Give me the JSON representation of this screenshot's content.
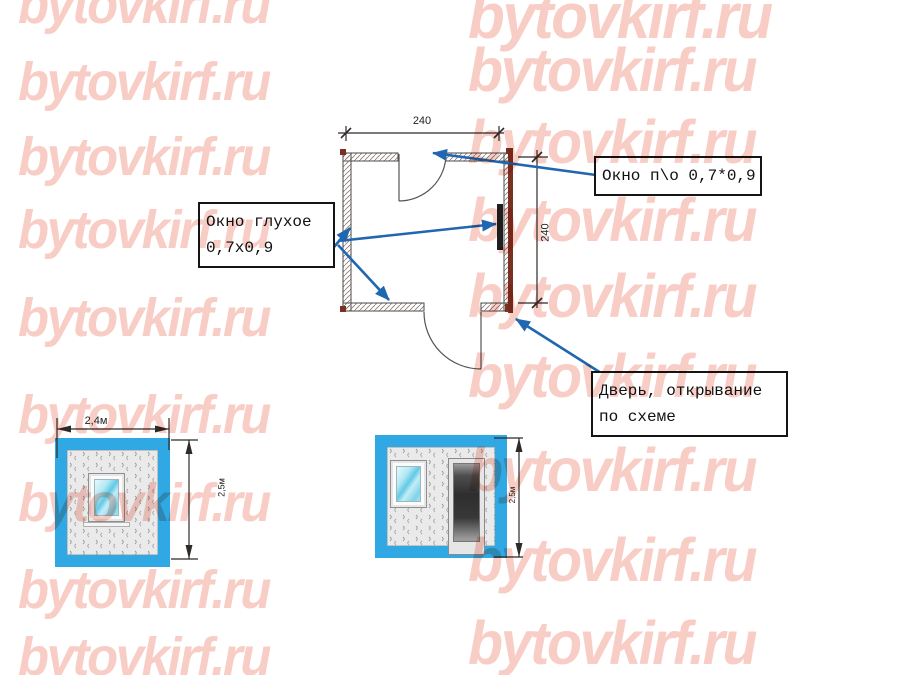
{
  "watermark": {
    "text": "bytovkirf.ru"
  },
  "colors": {
    "watermark_pink": "#f8cdc5",
    "arrow_blue": "#2166b1",
    "frame_blue": "#2fa8e4",
    "wall_maroon": "#7a3122",
    "dim_dark": "#2e2a28"
  },
  "plan": {
    "width_dim": "240",
    "height_dim": "240",
    "callouts": {
      "window_opening": {
        "lines": [
          "Окно п\\о  0,7*0,9"
        ]
      },
      "window_fixed": {
        "lines": [
          "Окно глухое",
          "0,7х0,9"
        ]
      },
      "door": {
        "lines": [
          "Дверь, открывание",
          "по схеме"
        ]
      }
    }
  },
  "elevations": {
    "front": {
      "width_dim": "2,4м",
      "height_dim": "2,5м"
    },
    "side": {
      "height_dim": "2,5м"
    }
  }
}
